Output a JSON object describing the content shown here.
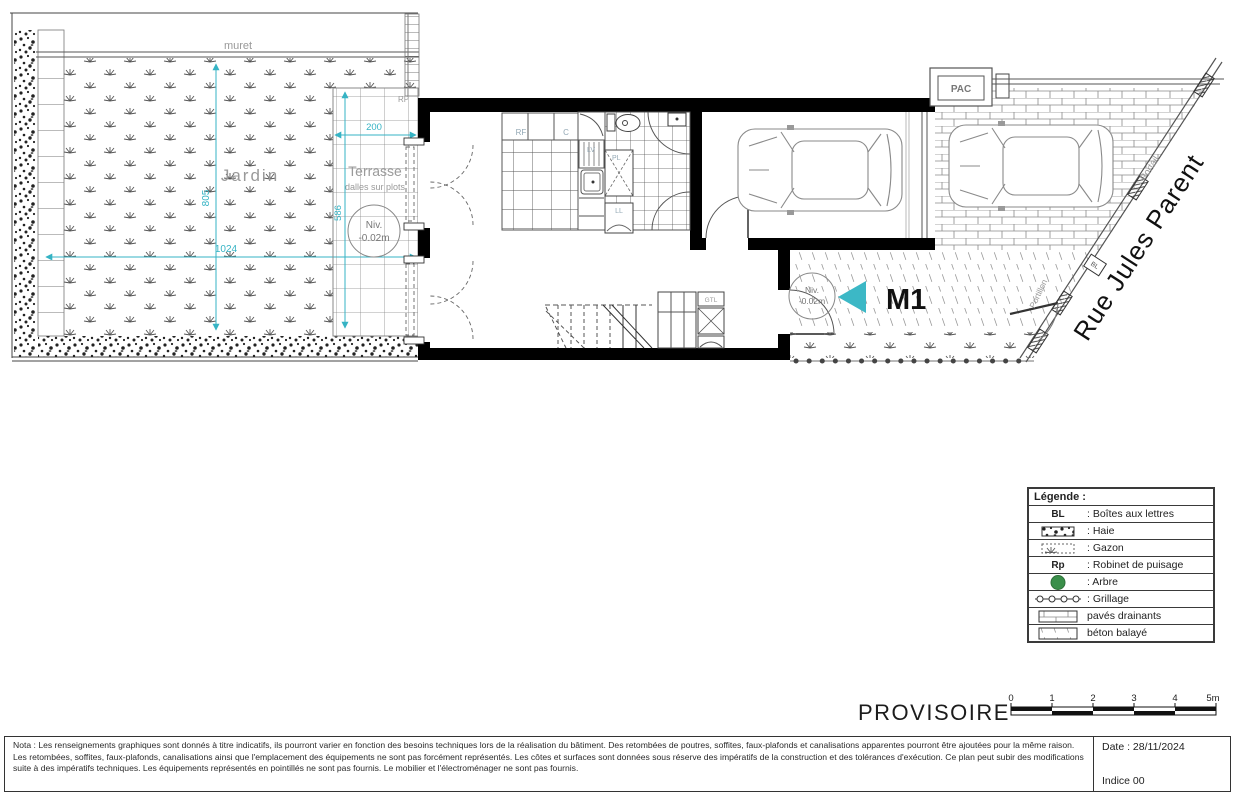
{
  "plan": {
    "labels": {
      "muret": "muret",
      "jardin": "Jardin",
      "terrasse": "Terrasse",
      "terrasse_sub": "dalles sur plots",
      "rp": "RP",
      "niv": "Niv.",
      "niv_value": "-0.02m",
      "rf": "RF",
      "c": "C",
      "lv": "LV",
      "pl": "PL",
      "ll": "LL",
      "gtl": "GTL",
      "pac": "PAC",
      "m1": "M1",
      "bl": "BL",
      "portail": "Portail",
      "portillon": "Portillon",
      "street": "Rue Jules Parent"
    },
    "dimensions": {
      "garden_width": "1024",
      "garden_height": "805",
      "terrace_width": "200",
      "terrace_height": "586"
    },
    "colors": {
      "dimension_cyan": "#35b3c4",
      "entry_arrow": "#3cb8c6",
      "tree_green": "#3a8f4a",
      "wall_black": "#000000"
    }
  },
  "legend": {
    "title": "Légende :",
    "rows": [
      {
        "label": "BL",
        "text": ": Boîtes aux lettres"
      },
      {
        "label": "",
        "text": ": Haie"
      },
      {
        "label": "",
        "text": ": Gazon"
      },
      {
        "label": "Rp",
        "text": ": Robinet de puisage"
      },
      {
        "label": "",
        "text": ": Arbre"
      },
      {
        "label": "",
        "text": ": Grillage"
      },
      {
        "label": "",
        "text": "pavés drainants"
      },
      {
        "label": "",
        "text": "béton balayé"
      }
    ]
  },
  "status": {
    "stamp": "PROVISOIRE"
  },
  "scalebar": {
    "ticks": [
      "0",
      "1",
      "2",
      "3",
      "4",
      "5m"
    ]
  },
  "titleblock": {
    "nota": "Nota : Les renseignements graphiques sont donnés à titre indicatifs, ils pourront varier en fonction des besoins techniques lors de la réalisation du bâtiment. Des retombées de poutres, soffites, faux-plafonds et canalisations apparentes pourront être ajoutées pour la même raison. Les retombées, soffites, faux-plafonds, canalisations ainsi que l'emplacement des équipements ne sont pas forcément représentés. Les côtes et surfaces sont données sous réserve des impératifs de la construction et des tolérances d'exécution. Ce plan peut subir des modifications suite à des impératifs techniques. Les équipements représentés en pointillés ne sont pas fournis. Le mobilier et l'électroménager ne sont pas fournis.",
    "date": "Date : 28/11/2024",
    "indice": "Indice 00"
  }
}
